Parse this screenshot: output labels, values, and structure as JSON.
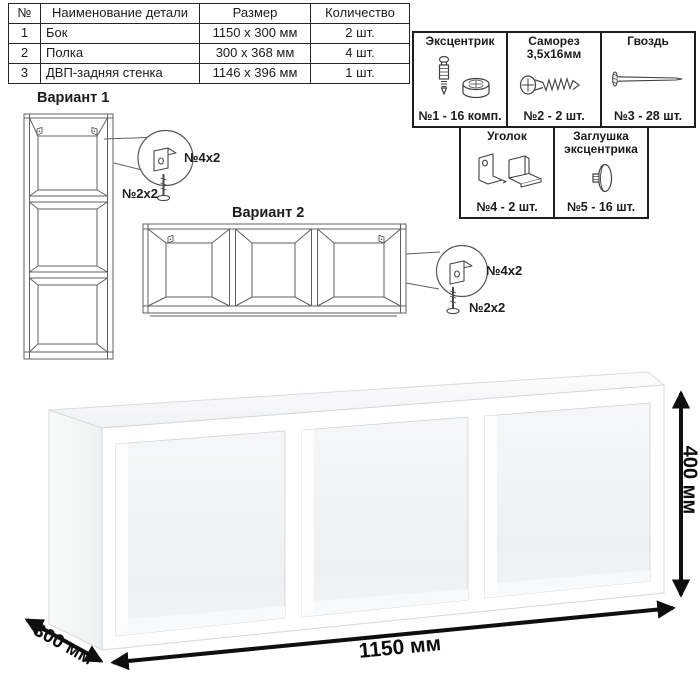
{
  "parts_table": {
    "headers": [
      "№",
      "Наименование детали",
      "Размер",
      "Количество"
    ],
    "rows": [
      {
        "num": "1",
        "name": "Бок",
        "size": "1150 x 300 мм",
        "qty": "2 шт."
      },
      {
        "num": "2",
        "name": "Полка",
        "size": "300 x 368 мм",
        "qty": "4 шт."
      },
      {
        "num": "3",
        "name": "ДВП-задняя стенка",
        "size": "1146 x 396 мм",
        "qty": "1 шт."
      }
    ]
  },
  "hardware": {
    "row1": [
      {
        "title": "Эксцентрик",
        "label": "№1 - 16 комп.",
        "icon": "cam-lock-icon"
      },
      {
        "title": "Саморез 3,5х16мм",
        "label": "№2 - 2 шт.",
        "icon": "screw-icon"
      },
      {
        "title": "Гвоздь",
        "label": "№3 - 28 шт.",
        "icon": "nail-icon"
      }
    ],
    "row2": [
      {
        "title": "Уголок",
        "label": "№4 - 2 шт.",
        "icon": "corner-bracket-icon"
      },
      {
        "title": "Заглушка эксцентрика",
        "label": "№5 - 16 шт.",
        "icon": "cam-cap-icon"
      }
    ]
  },
  "variants": {
    "v1": {
      "title": "Вариант 1",
      "bracket_qty": "№4х2",
      "screw_qty": "№2х2"
    },
    "v2": {
      "title": "Вариант 2",
      "bracket_qty": "№4х2",
      "screw_qty": "№2х2"
    }
  },
  "dimensions": {
    "width": "1150 мм",
    "height": "400 мм",
    "depth": "300 мм"
  },
  "colors": {
    "line_drawing": "#5a5a5a",
    "arrow": "#0f0f0f",
    "table_border": "#262626",
    "shade": "#eceef0"
  }
}
